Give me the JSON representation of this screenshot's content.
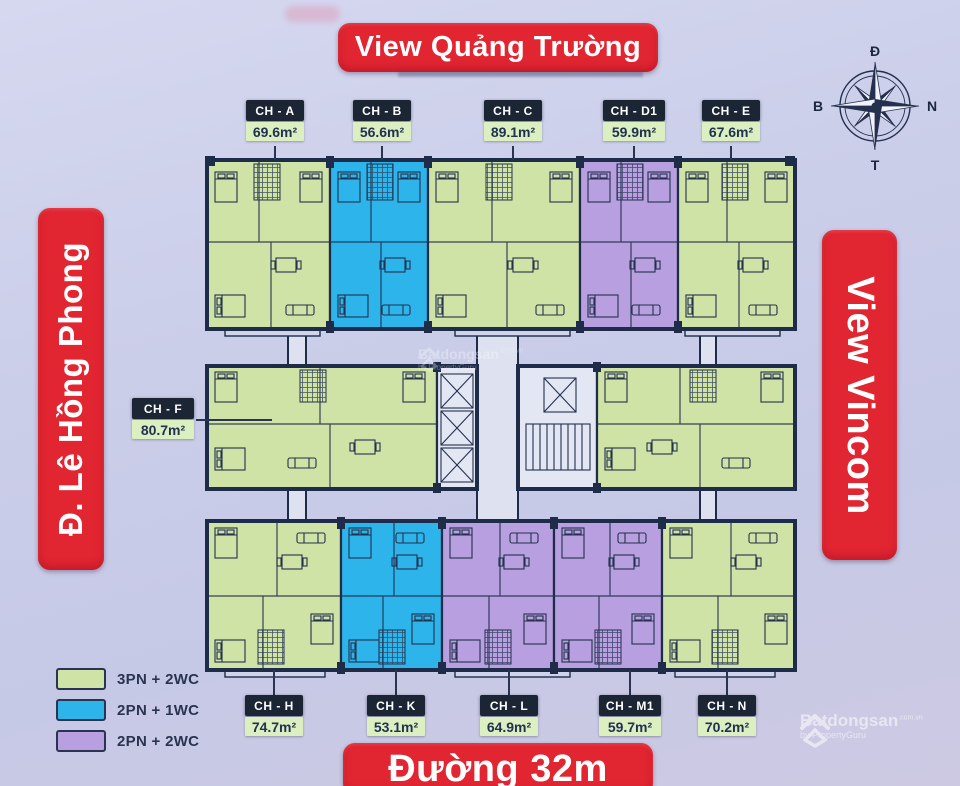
{
  "page": {
    "title_top": "View Quảng Trường",
    "street_left": "Đ. Lê Hồng Phong",
    "label_right": "View Vincom",
    "street_bottom": "Đường 32m"
  },
  "compass": {
    "top": "Đ",
    "right": "N",
    "bottom": "T",
    "left": "B"
  },
  "units": [
    {
      "id": "CH - A",
      "area": "69.6m²",
      "color": "green",
      "type": "3PN + 2WC",
      "wing": "top"
    },
    {
      "id": "CH - B",
      "area": "56.6m²",
      "color": "blue",
      "type": "2PN + 1WC",
      "wing": "top"
    },
    {
      "id": "CH - C",
      "area": "89.1m²",
      "color": "green",
      "type": "3PN + 2WC",
      "wing": "top"
    },
    {
      "id": "CH - D1",
      "area": "59.9m²",
      "color": "purple",
      "type": "2PN + 2WC",
      "wing": "top"
    },
    {
      "id": "CH - E",
      "area": "67.6m²",
      "color": "green",
      "type": "3PN + 2WC",
      "wing": "top"
    },
    {
      "id": "CH - F",
      "area": "80.7m²",
      "color": "green",
      "type": "3PN + 2WC",
      "wing": "middle"
    },
    {
      "id": "CH - H",
      "area": "74.7m²",
      "color": "green",
      "type": "3PN + 2WC",
      "wing": "bottom"
    },
    {
      "id": "CH - K",
      "area": "53.1m²",
      "color": "blue",
      "type": "2PN + 1WC",
      "wing": "bottom"
    },
    {
      "id": "CH - L",
      "area": "64.9m²",
      "color": "purple",
      "type": "2PN + 2WC",
      "wing": "bottom"
    },
    {
      "id": "CH - M1",
      "area": "59.7m²",
      "color": "purple",
      "type": "2PN + 2WC",
      "wing": "bottom"
    },
    {
      "id": "CH - N",
      "area": "70.2m²",
      "color": "green",
      "type": "3PN + 2WC",
      "wing": "bottom"
    }
  ],
  "legend": [
    {
      "label": "3PN + 2WC",
      "color": "#cfe3a6"
    },
    {
      "label": "2PN + 1WC",
      "color": "#2db4ea"
    },
    {
      "label": "2PN + 2WC",
      "color": "#b79fe0"
    }
  ],
  "watermark": {
    "brand": "Batdongsan",
    "suffix": ".com.vn",
    "byline": "by PropertyGuru"
  },
  "colors": {
    "background": "#c9cce8",
    "banner_red": "#e12531",
    "wall": "#1f2c49",
    "unit_green": "#cfe3a6",
    "unit_blue": "#2db4ea",
    "unit_purple": "#b79fe0",
    "label_header_bg": "#1b2534",
    "label_area_bg": "#dcefc0"
  }
}
